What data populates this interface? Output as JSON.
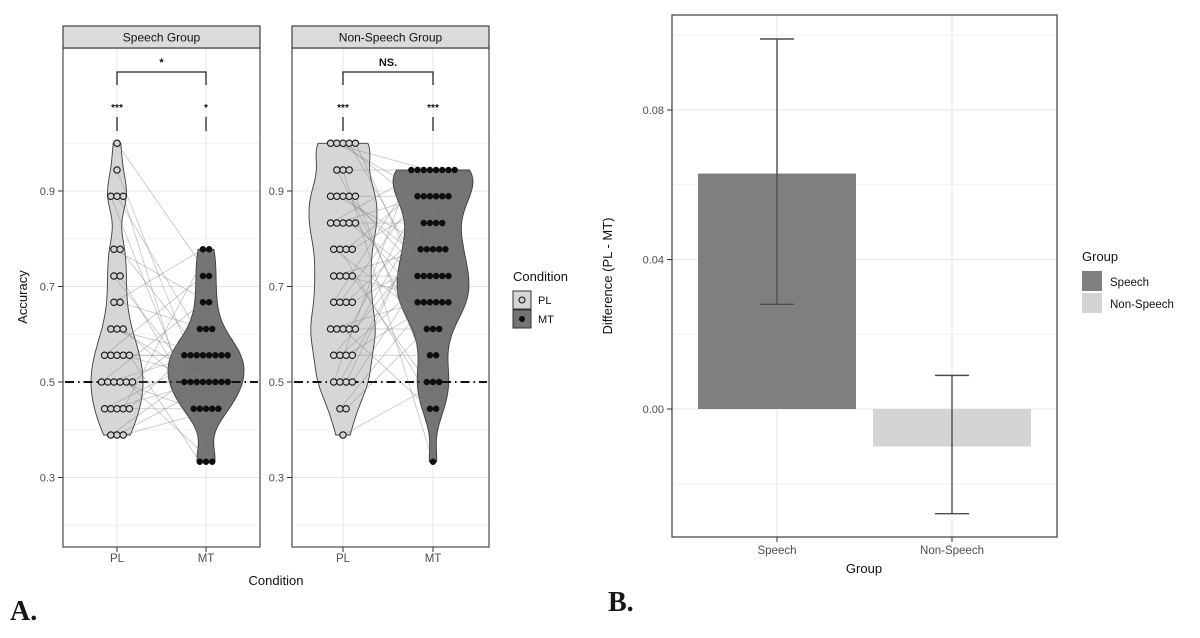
{
  "figure_labels": {
    "a": "A.",
    "b": "B."
  },
  "colors": {
    "pl_fill": "#d6d6d6",
    "mt_fill": "#747474",
    "violin_stroke": "#3d3d3d",
    "point_pl_fill": "#d2d2d2",
    "point_stroke": "#141414",
    "point_mt_fill": "#0e0e0e",
    "pair_line": "#808080",
    "reference_line": "#111111",
    "bar_speech": "#7f7f7f",
    "bar_nonspeech": "#d4d4d4",
    "error_bar": "#4d4d4d",
    "strip_fill": "#dbdbdb",
    "panel_border": "#4b4b4b",
    "grid_major": "#e4e4e4",
    "grid_minor": "#f1f1f1",
    "tick_label": "#4d4d4d",
    "text": "#111111"
  },
  "chart_data": [
    {
      "id": "panel_a",
      "type": "violin-dotplot-paired",
      "facet_titles": [
        "Speech Group",
        "Non-Speech Group"
      ],
      "xlabel": "Condition",
      "ylabel": "Accuracy",
      "x_categories": [
        "PL",
        "MT"
      ],
      "y_ticks": [
        0.3,
        0.5,
        0.7,
        0.9
      ],
      "y_tick_labels": [
        "0.3",
        "0.5",
        "0.7",
        "0.9"
      ],
      "y_minor_ticks": [
        0.2,
        0.4,
        0.6,
        0.8,
        1.0
      ],
      "ylim": [
        0.155,
        1.205
      ],
      "reference_line": 0.5,
      "grid": true,
      "legend": {
        "title": "Condition",
        "entries": [
          "PL",
          "MT"
        ],
        "position": "right"
      },
      "facets": [
        {
          "title": "Speech Group",
          "significance": {
            "between": "*",
            "PL": "***",
            "MT": "*"
          },
          "PL": [
            [
              1.0,
              1
            ],
            [
              0.944,
              1
            ],
            [
              0.889,
              3
            ],
            [
              0.778,
              2
            ],
            [
              0.722,
              2
            ],
            [
              0.667,
              2
            ],
            [
              0.611,
              3
            ],
            [
              0.556,
              5
            ],
            [
              0.5,
              6
            ],
            [
              0.444,
              5
            ],
            [
              0.389,
              3
            ]
          ],
          "MT": [
            [
              0.778,
              2
            ],
            [
              0.722,
              2
            ],
            [
              0.667,
              2
            ],
            [
              0.611,
              3
            ],
            [
              0.556,
              8
            ],
            [
              0.5,
              8
            ],
            [
              0.444,
              5
            ],
            [
              0.333,
              3
            ]
          ]
        },
        {
          "title": "Non-Speech Group",
          "significance": {
            "between": "NS.",
            "PL": "***",
            "MT": "***"
          },
          "PL": [
            [
              1.0,
              5
            ],
            [
              0.944,
              3
            ],
            [
              0.889,
              5
            ],
            [
              0.833,
              5
            ],
            [
              0.778,
              4
            ],
            [
              0.722,
              4
            ],
            [
              0.667,
              4
            ],
            [
              0.611,
              5
            ],
            [
              0.556,
              4
            ],
            [
              0.5,
              4
            ],
            [
              0.444,
              2
            ],
            [
              0.389,
              1
            ]
          ],
          "MT": [
            [
              0.944,
              8
            ],
            [
              0.889,
              6
            ],
            [
              0.833,
              4
            ],
            [
              0.778,
              5
            ],
            [
              0.722,
              6
            ],
            [
              0.667,
              6
            ],
            [
              0.611,
              3
            ],
            [
              0.556,
              2
            ],
            [
              0.5,
              3
            ],
            [
              0.444,
              2
            ],
            [
              0.333,
              1
            ]
          ]
        }
      ]
    },
    {
      "id": "panel_b",
      "type": "bar",
      "categories": [
        "Speech",
        "Non-Speech"
      ],
      "values": [
        0.063,
        -0.01
      ],
      "error_low": [
        0.028,
        -0.028
      ],
      "error_high": [
        0.099,
        0.009
      ],
      "xlabel": "Group",
      "ylabel": "Difference (PL - MT)",
      "y_ticks": [
        0.0,
        0.04,
        0.08
      ],
      "y_tick_labels": [
        "0.00",
        "0.04",
        "0.08"
      ],
      "y_minor_ticks": [
        -0.02,
        0.02,
        0.06,
        0.1
      ],
      "ylim": [
        -0.0343,
        0.1055
      ],
      "grid": true,
      "legend": {
        "title": "Group",
        "entries": [
          "Speech",
          "Non-Speech"
        ],
        "position": "right"
      }
    }
  ]
}
